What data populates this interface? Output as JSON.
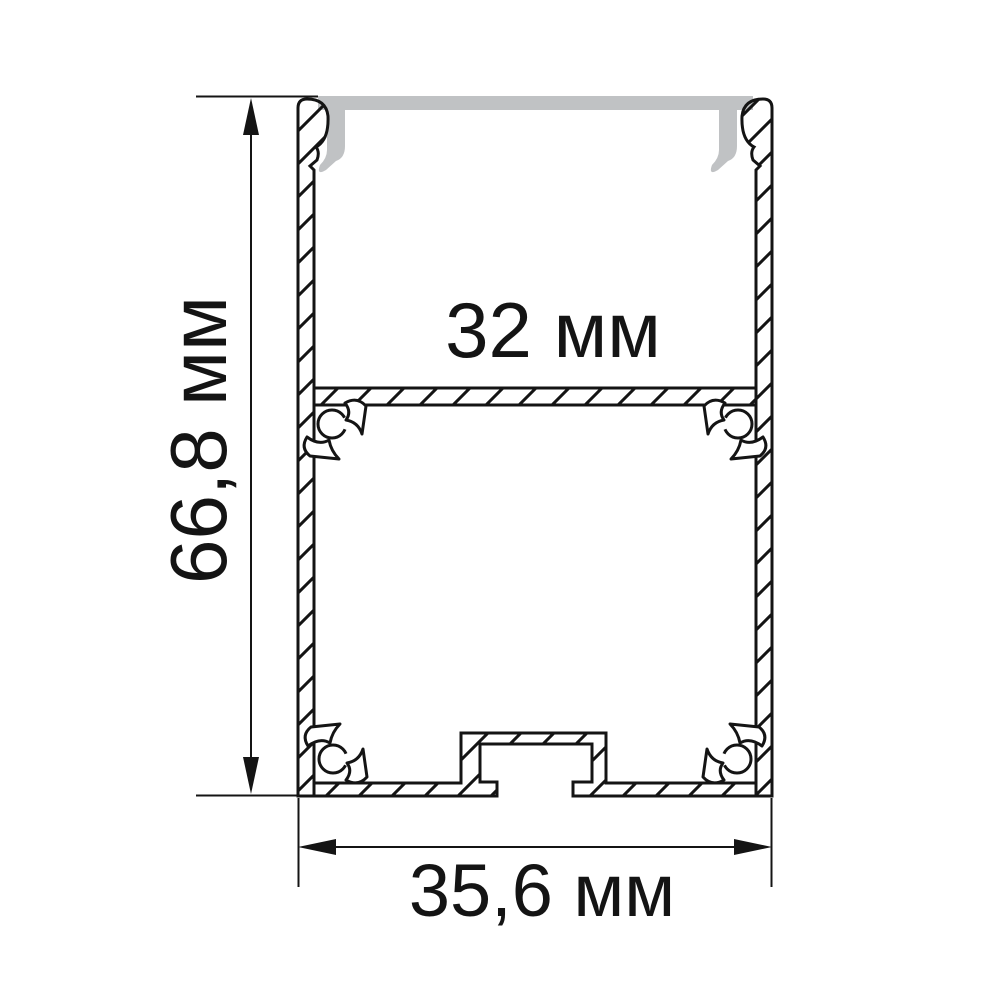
{
  "drawing": {
    "type": "technical-cross-section",
    "subject": "aluminium-led-profile",
    "dimensions": {
      "height": {
        "value": "66,8 мм"
      },
      "inner_width": {
        "value": "32 мм"
      },
      "outer_width": {
        "value": "35,6 мм"
      }
    },
    "colors": {
      "ink": "#141414",
      "diffuser_gray": "#c0c2c4",
      "background": "#ffffff"
    }
  }
}
